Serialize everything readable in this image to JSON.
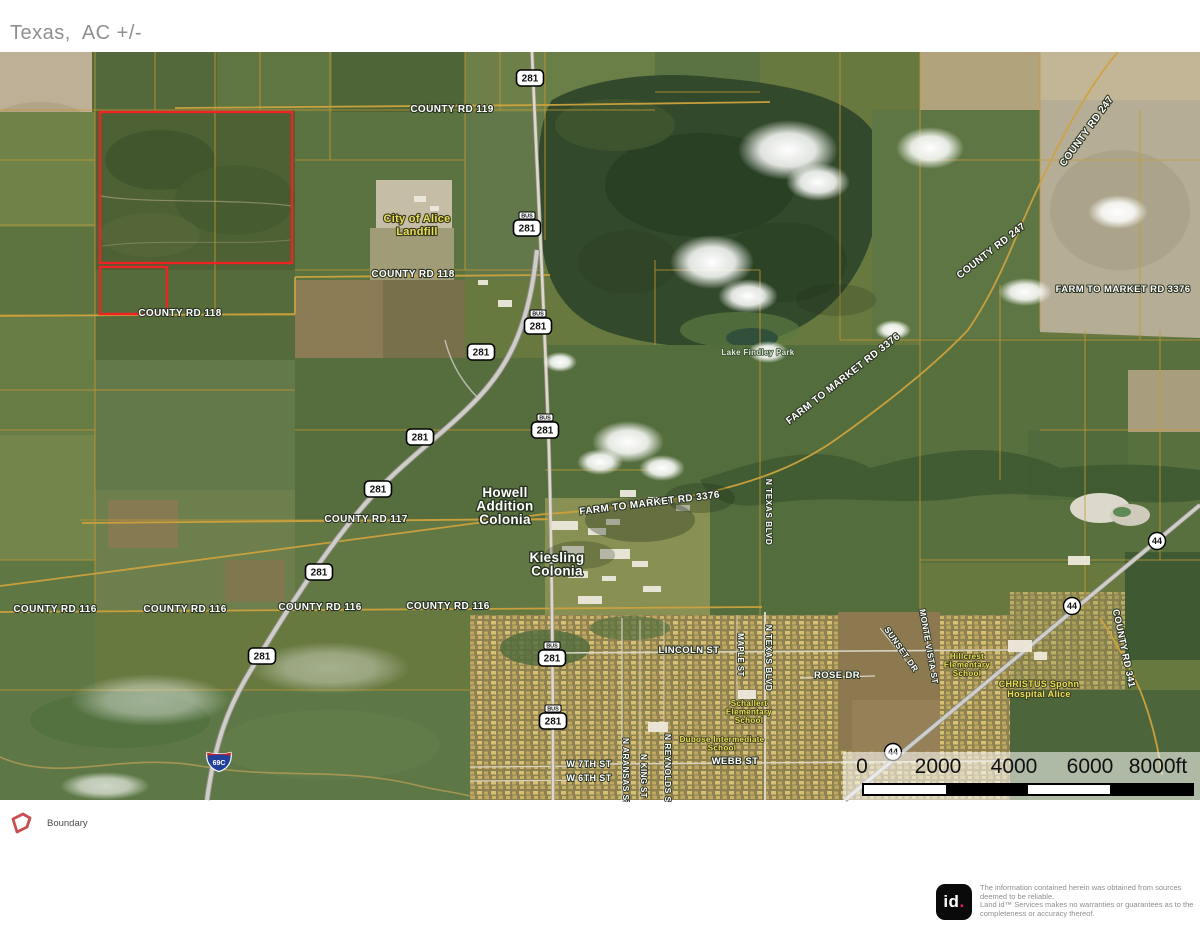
{
  "title": "Texas,  AC +/-",
  "colors": {
    "boundary_red": "#ee2424",
    "parcel_gold": "#c79a36",
    "label_yellow": "#e9df55",
    "logo_dot_pink": "#e6215f",
    "title_gray": "#8f8f8f"
  },
  "legend": {
    "boundary_label": "Boundary"
  },
  "scale_bar": {
    "ticks": [
      "0",
      "2000",
      "4000",
      "6000",
      "8000ft"
    ],
    "unit": "ft"
  },
  "disclaimer": {
    "logo_text": "id",
    "logo_dot": ".",
    "lines": [
      "The information contained herein was obtained from sources",
      "deemed to be reliable.",
      "Land id™ Services makes no warranties or guarantees as to the",
      "completeness or accuracy thereof."
    ]
  },
  "map": {
    "boundary": {
      "rects": [
        {
          "x": 100,
          "y": 112,
          "w": 192,
          "h": 151
        },
        {
          "x": 100,
          "y": 267,
          "w": 67,
          "h": 47
        }
      ]
    },
    "road_labels": [
      {
        "t": "COUNTY RD 119",
        "x": 452,
        "y": 112,
        "s": 10,
        "r": 0
      },
      {
        "t": "COUNTY RD 118",
        "x": 413,
        "y": 277,
        "s": 10,
        "r": 0
      },
      {
        "t": "COUNTY RD 118",
        "x": 180,
        "y": 316,
        "s": 10,
        "r": 0
      },
      {
        "t": "COUNTY RD 117",
        "x": 366,
        "y": 522,
        "s": 10,
        "r": 0
      },
      {
        "t": "COUNTY RD 116",
        "x": 55,
        "y": 612,
        "s": 10,
        "r": 0
      },
      {
        "t": "COUNTY RD 116",
        "x": 185,
        "y": 612,
        "s": 10,
        "r": 0
      },
      {
        "t": "COUNTY RD 116",
        "x": 320,
        "y": 610,
        "s": 10,
        "r": 0
      },
      {
        "t": "COUNTY RD 116",
        "x": 448,
        "y": 609,
        "s": 10,
        "r": 0
      },
      {
        "t": "FARM TO MARKET RD 3376",
        "x": 845,
        "y": 381,
        "s": 10,
        "r": -38
      },
      {
        "t": "FARM TO MARKET RD 3376",
        "x": 1123,
        "y": 292,
        "s": 9.5,
        "r": 0
      },
      {
        "t": "FARM TO MARKET RD 3376",
        "x": 650,
        "y": 506,
        "s": 10,
        "r": -7
      },
      {
        "t": "COUNTY RD 247",
        "x": 1089,
        "y": 133,
        "s": 10,
        "r": -54
      },
      {
        "t": "COUNTY RD 247",
        "x": 993,
        "y": 253,
        "s": 10,
        "r": -38
      },
      {
        "t": "COUNTY RD 341",
        "x": 1121,
        "y": 649,
        "s": 9.5,
        "r": 78
      },
      {
        "t": "LINCOLN ST",
        "x": 689,
        "y": 653,
        "s": 9.5,
        "r": 0
      },
      {
        "t": "WEBB ST",
        "x": 735,
        "y": 764,
        "s": 9.5,
        "r": 0
      },
      {
        "t": "W 7TH ST",
        "x": 589,
        "y": 767,
        "s": 9,
        "r": 0
      },
      {
        "t": "W 6TH ST",
        "x": 589,
        "y": 781,
        "s": 9,
        "r": 0
      },
      {
        "t": "ROSE DR",
        "x": 837,
        "y": 678,
        "s": 9.5,
        "r": 0
      },
      {
        "t": "N TEXAS BLVD",
        "x": 766,
        "y": 512,
        "s": 8.5,
        "r": 90
      },
      {
        "t": "N TEXAS BLVD",
        "x": 766,
        "y": 658,
        "s": 8.5,
        "r": 90
      },
      {
        "t": "N ARANSAS ST",
        "x": 623,
        "y": 772,
        "s": 8.5,
        "r": 90
      },
      {
        "t": "N REYNOLDS ST",
        "x": 665,
        "y": 771,
        "s": 8.5,
        "r": 90
      },
      {
        "t": "N KING ST",
        "x": 641,
        "y": 776,
        "s": 8,
        "r": 90
      },
      {
        "t": "MAPLE ST",
        "x": 738,
        "y": 655,
        "s": 8,
        "r": 90
      },
      {
        "t": "MONTE VISTA ST",
        "x": 926,
        "y": 647,
        "s": 8.5,
        "r": 80
      },
      {
        "t": "SUNSET DR",
        "x": 899,
        "y": 651,
        "s": 8.5,
        "r": 55
      }
    ],
    "place_labels": [
      {
        "lines": [
          "City of Alice",
          "Landfill"
        ],
        "x": 417,
        "y": 222,
        "s": 11,
        "c": "yellow",
        "lh": 13
      },
      {
        "lines": [
          "Lake Findley Park"
        ],
        "x": 758,
        "y": 355,
        "s": 8,
        "c": "pale",
        "lh": 9
      },
      {
        "lines": [
          "Howell",
          "Addition",
          "Colonia"
        ],
        "x": 505,
        "y": 497,
        "s": 13.5,
        "c": "white",
        "lh": 13.5
      },
      {
        "lines": [
          "Kiesling",
          "Colonia"
        ],
        "x": 557,
        "y": 562,
        "s": 13.5,
        "c": "white",
        "lh": 13.5
      },
      {
        "lines": [
          "Hillcrest",
          "Elementary",
          "School"
        ],
        "x": 967,
        "y": 659,
        "s": 8,
        "c": "yellow",
        "lh": 8.5
      },
      {
        "lines": [
          "CHRISTUS Spohn",
          "Hospital Alice"
        ],
        "x": 1039,
        "y": 687,
        "s": 9,
        "c": "yellow",
        "lh": 10
      },
      {
        "lines": [
          "Schallert",
          "Elementary",
          "School"
        ],
        "x": 749,
        "y": 706,
        "s": 8,
        "c": "yellow",
        "lh": 8.5
      },
      {
        "lines": [
          "Dubose Intermediate",
          "School"
        ],
        "x": 722,
        "y": 742,
        "s": 8,
        "c": "yellow",
        "lh": 8.5
      }
    ],
    "shields": [
      {
        "k": "us",
        "t": "281",
        "x": 530,
        "y": 78
      },
      {
        "k": "bus",
        "t": "281",
        "banner": "BUS",
        "x": 527,
        "y": 228
      },
      {
        "k": "bus",
        "t": "281",
        "banner": "BUS",
        "x": 538,
        "y": 326
      },
      {
        "k": "us",
        "t": "281",
        "x": 481,
        "y": 352
      },
      {
        "k": "bus",
        "t": "281",
        "banner": "BUS",
        "x": 545,
        "y": 430
      },
      {
        "k": "us",
        "t": "281",
        "x": 420,
        "y": 437
      },
      {
        "k": "us",
        "t": "281",
        "x": 378,
        "y": 489
      },
      {
        "k": "us",
        "t": "281",
        "x": 319,
        "y": 572
      },
      {
        "k": "us",
        "t": "281",
        "x": 262,
        "y": 656
      },
      {
        "k": "bus",
        "t": "281",
        "banner": "BUS",
        "x": 552,
        "y": 658
      },
      {
        "k": "bus",
        "t": "281",
        "banner": "BUS",
        "x": 553,
        "y": 721
      },
      {
        "k": "c",
        "t": "44",
        "x": 1157,
        "y": 541
      },
      {
        "k": "c",
        "t": "44",
        "x": 1072,
        "y": 606
      },
      {
        "k": "c",
        "t": "44",
        "x": 893,
        "y": 752
      },
      {
        "k": "i",
        "t": "69C",
        "x": 219,
        "y": 761
      }
    ]
  }
}
